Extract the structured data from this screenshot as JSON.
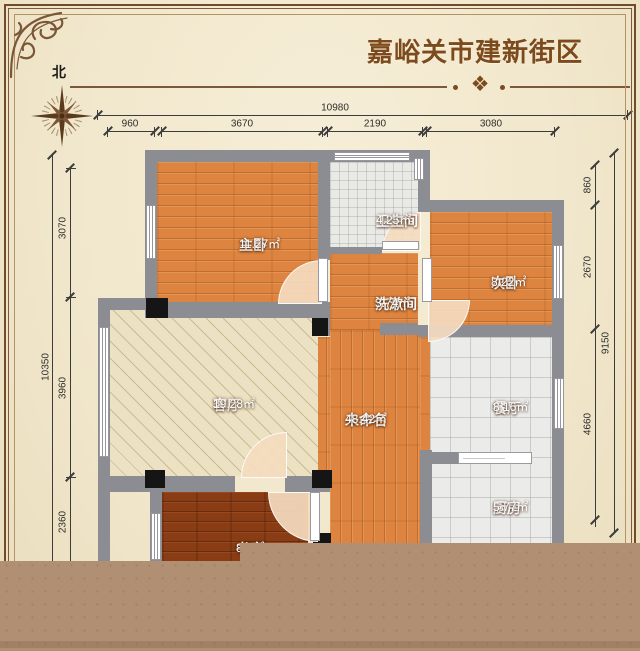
{
  "title": "嘉峪关市建新街区",
  "compass": {
    "north_label": "北"
  },
  "decor": {
    "divider_ornament": "❖"
  },
  "dimensions": {
    "top": {
      "total": "10980",
      "segments": [
        "960",
        "3670",
        "2190",
        "3080"
      ]
    },
    "left": {
      "total": "10350",
      "segments": [
        "3070",
        "3960",
        "2360"
      ]
    },
    "right": {
      "total": "9150",
      "segments": [
        "860",
        "2670",
        "4660"
      ]
    }
  },
  "rooms": [
    {
      "id": "master-bedroom",
      "name": "主卧",
      "area": "11.27㎡"
    },
    {
      "id": "bathroom",
      "name": "卫生间",
      "area": "4.25㎡"
    },
    {
      "id": "second-bedroom",
      "name": "次卧",
      "area": "8.22㎡"
    },
    {
      "id": "washroom",
      "name": "洗漱间",
      "area": "3.74㎡"
    },
    {
      "id": "living-room",
      "name": "客厅",
      "area": "19.28㎡"
    },
    {
      "id": "unnamed",
      "name": "未命名",
      "area": "48.42㎡"
    },
    {
      "id": "dining-room",
      "name": "餐厅",
      "area": "8.16㎡"
    },
    {
      "id": "kitchen",
      "name": "厨房",
      "area": "5.77㎡"
    },
    {
      "id": "study",
      "name": "书房",
      "area": "8.8㎡"
    }
  ],
  "colors": {
    "background": "#f1e7cc",
    "frame": "#6e4c2c",
    "title_text": "#7c4a1d",
    "wall": "#8c8c93",
    "wood_floor": "#dd8440",
    "dark_wood_floor": "#8a3c14",
    "living_floor": "#ece1c2",
    "tile_floor": "#ebebe9",
    "column": "#151515",
    "bottom_overlay": "#b08f73"
  }
}
